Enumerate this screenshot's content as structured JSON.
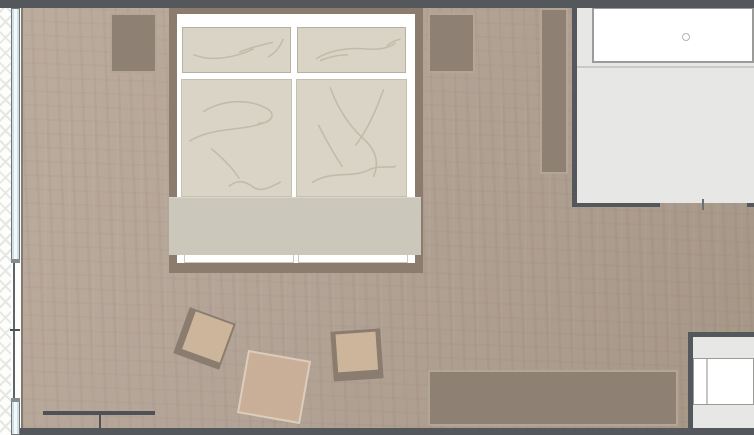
{
  "document": {
    "title": "Bedroom floor plan",
    "type": "architectural floor plan, top-down view"
  },
  "rooms": [
    {
      "name": "bedroom",
      "floor": "wood"
    },
    {
      "name": "bathroom",
      "floor": "tile"
    },
    {
      "name": "adjacent-room",
      "floor": "tile"
    },
    {
      "name": "outside",
      "floor": "hatched"
    }
  ],
  "furniture": [
    {
      "name": "double bed with two pillows and two duvets"
    },
    {
      "name": "nightstand left"
    },
    {
      "name": "nightstand right"
    },
    {
      "name": "wardrobe"
    },
    {
      "name": "sideboard bench"
    },
    {
      "name": "floor cushion left"
    },
    {
      "name": "floor cushion middle"
    },
    {
      "name": "floor cushion right"
    },
    {
      "name": "radiator"
    },
    {
      "name": "washbasin counter"
    },
    {
      "name": "bathtub"
    },
    {
      "name": "bed throw blanket"
    },
    {
      "name": "window band left"
    },
    {
      "name": "bathroom door opening"
    }
  ],
  "icons": [
    {
      "name": "basin-drain-icon",
      "meaning": "circular basin drain on washbasin counter"
    }
  ],
  "colors": {
    "wall": "#54585c",
    "floor_wood": "#b3a396",
    "floor_wood_light": "#bcac9e",
    "floor_wood_dark": "#a69686",
    "bathroom_floor": "#e7e7e5",
    "outside": "#fdfdfc",
    "glass": "#cfe0e4",
    "bed_frame": "#8b7c6e",
    "bed_base": "#ffffff",
    "textile": "#d9d4c5",
    "textile_line": "#c2bbaa",
    "throw": "#cbc8bb",
    "furniture_fill": "#8e8174",
    "furniture_border": "#b4a696",
    "pouf_tan": "#cdb59b",
    "pouf_mid": "#c9af97",
    "pouf_border_dark": "#8a7d70",
    "fixture_fill": "#ffffff",
    "fixture_border": "#9b9b99",
    "radiator": "#4e5256"
  }
}
